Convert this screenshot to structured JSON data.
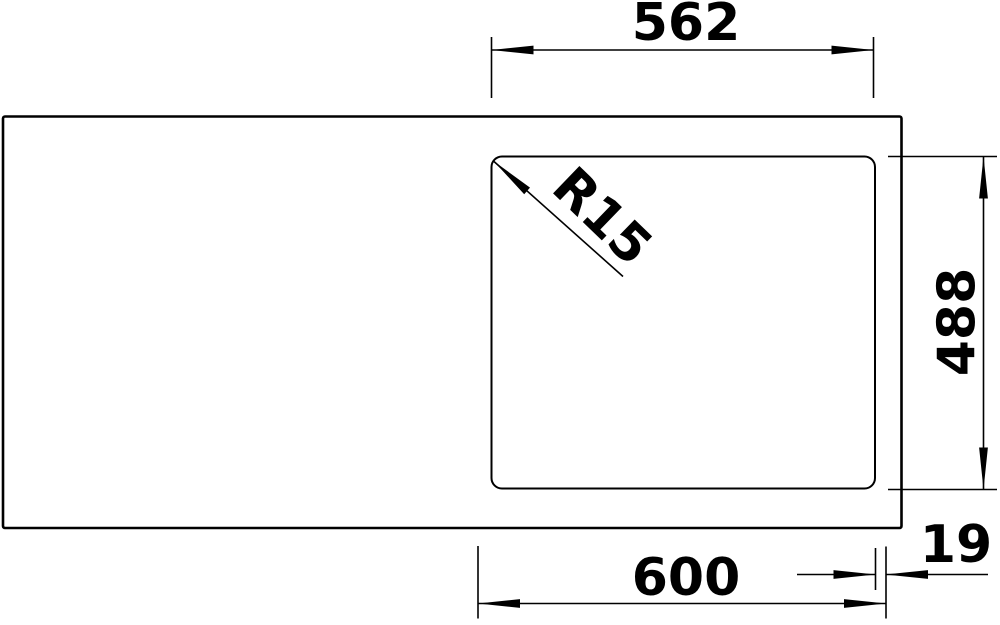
{
  "drawing": {
    "description": "Technical dimension drawing of a rectangular sink top with an inset rounded-corner bowl cutout",
    "background_color": "#ffffff",
    "line_color": "#000000",
    "text_color": "#000000",
    "labels": {
      "top_width": "562",
      "right_height": "488",
      "bottom_width": "600",
      "edge_offset": "19",
      "corner_radius": "R15"
    },
    "units": "mm"
  }
}
